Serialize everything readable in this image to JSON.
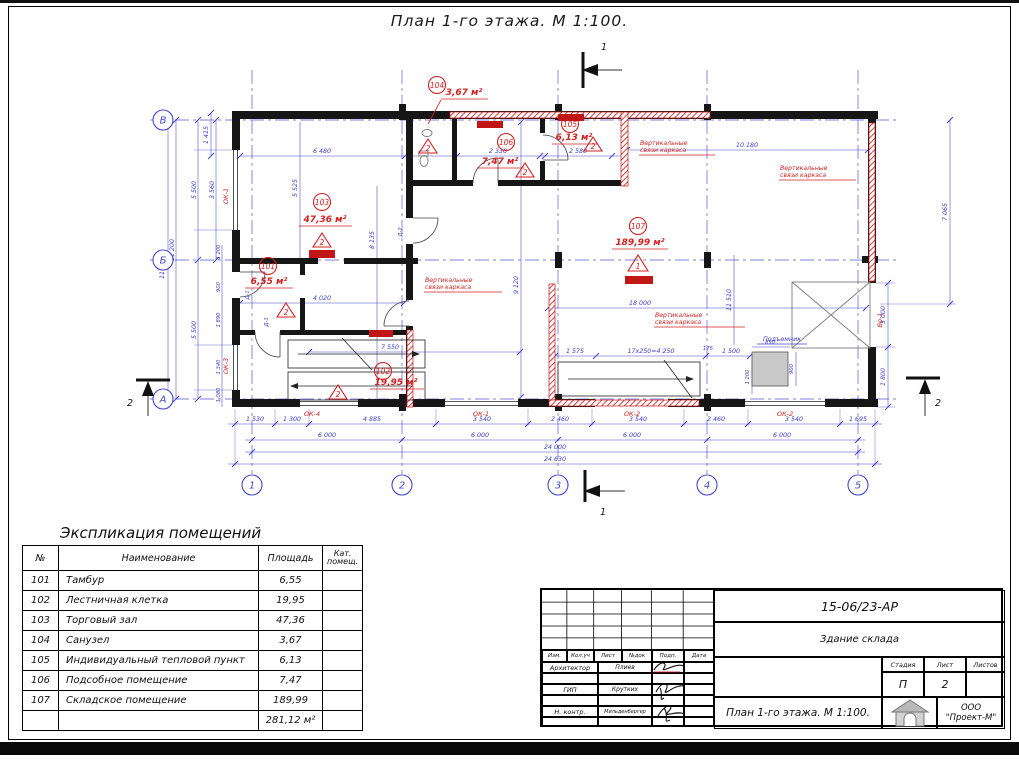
{
  "sheet": {
    "title": "План 1-го этажа. М 1:100."
  },
  "plan": {
    "axes": {
      "cols": [
        "1",
        "2",
        "3",
        "4",
        "5"
      ],
      "rows": [
        "В",
        "Б",
        "А"
      ]
    },
    "sections": {
      "one": "1",
      "two": "2"
    },
    "rooms": [
      {
        "id": "101",
        "area": "6,55 м²",
        "cat": "2"
      },
      {
        "id": "102",
        "area": "19,95 м²",
        "cat": "2"
      },
      {
        "id": "103",
        "area": "47,36 м²",
        "cat": "2"
      },
      {
        "id": "104",
        "area": "3,67 м²",
        "cat": "2"
      },
      {
        "id": "105",
        "area": "6,13 м²",
        "cat": "2"
      },
      {
        "id": "106",
        "area": "7,47 м²",
        "cat": "2"
      },
      {
        "id": "107",
        "area": "189,99 м²",
        "cat": "1"
      }
    ],
    "labels": {
      "braces1": "Вертикальные",
      "braces2": "связи каркаса",
      "lift": "Подъемник",
      "ok1": "ОК-1",
      "ok2": "ОК-2",
      "ok3": "ОК-3",
      "ok4": "ОК-4",
      "vr1": "Вр-1",
      "d1": "Д-1",
      "d2": "Д-2",
      "d3": "Д-3"
    },
    "dims": {
      "top": [
        "1 415",
        "6 480",
        "2 330",
        "2 580",
        "10 180"
      ],
      "left": [
        "11 865",
        "11 200",
        "5 500",
        "3 560",
        "5 525",
        "1 200",
        "900",
        "1 890",
        "1 340",
        "1 080",
        "5 500"
      ],
      "right": [
        "7 065",
        "3 000",
        "1 800",
        "11 510"
      ],
      "inner": [
        "4 020",
        "9 120",
        "8 135",
        "18 000",
        "1 575",
        "17x250=4 250",
        "175",
        "1 500",
        "1 200",
        "7 550",
        "850",
        "900"
      ],
      "bottom1": [
        "1 530",
        "1 300",
        "4 885",
        "3 540",
        "2 460",
        "3 540",
        "2 460",
        "3 540",
        "1 695"
      ],
      "bottom2": [
        "6 000",
        "6 000",
        "6 000",
        "6 000"
      ],
      "bottom3": "24 000",
      "bottom4": "24 630"
    }
  },
  "table": {
    "title": "Экспликация помещений",
    "headers": {
      "num": "№",
      "name": "Наименование",
      "area": "Площадь",
      "cat1": "Кат.",
      "cat2": "помещ."
    },
    "rows": [
      [
        "101",
        "Тамбур",
        "6,55"
      ],
      [
        "102",
        "Лестничная клетка",
        "19,95"
      ],
      [
        "103",
        "Торговый зал",
        "47,36"
      ],
      [
        "104",
        "Санузел",
        "3,67"
      ],
      [
        "105",
        "Индивидуальный тепловой пункт",
        "6,13"
      ],
      [
        "106",
        "Подсобное помещение",
        "7,47"
      ],
      [
        "107",
        "Складское помещение",
        "189,99"
      ]
    ],
    "total": "281,12 м²"
  },
  "titleblock": {
    "doc_number": "15-06/23-АР",
    "object_name": "Здание склада",
    "header_cells": [
      "Изм.",
      "Кол.уч",
      "Лист",
      "№док",
      "Подп.",
      "Дата"
    ],
    "roles": [
      {
        "role": "Архитектор",
        "name": "Плиев"
      },
      {
        "role": "ГИП",
        "name": "Крутких"
      },
      {
        "role": "Н. контр.",
        "name": "Мильденбергер"
      }
    ],
    "stage_label": "Стадия",
    "sheet_label": "Лист",
    "sheets_label": "Листов",
    "stage": "П",
    "sheet_num": "2",
    "drawing_name": "План 1-го этажа. М 1:100.",
    "company_line1": "ООО",
    "company_line2": "\"Проект-М\""
  }
}
